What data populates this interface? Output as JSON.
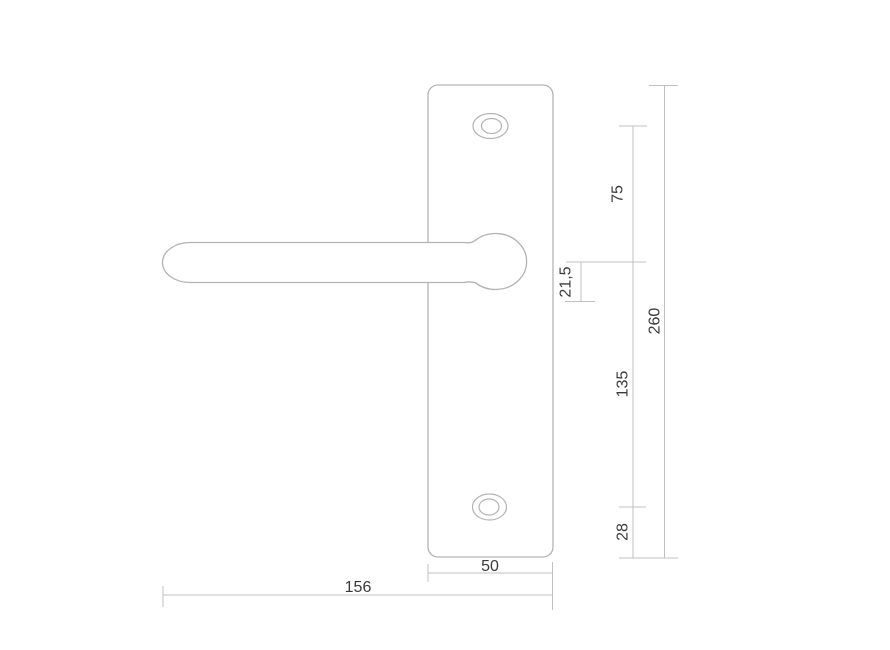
{
  "drawing": {
    "type": "technical-dimension-drawing",
    "colors": {
      "part_outline": "#b3b3b3",
      "dimension_line": "#c0c0c0",
      "label_text": "#3a3a3a",
      "background": "#ffffff"
    },
    "dims": {
      "d75": "75",
      "d21_5": "21,5",
      "d260": "260",
      "d135": "135",
      "d28": "28",
      "d50": "50",
      "d156": "156"
    }
  }
}
